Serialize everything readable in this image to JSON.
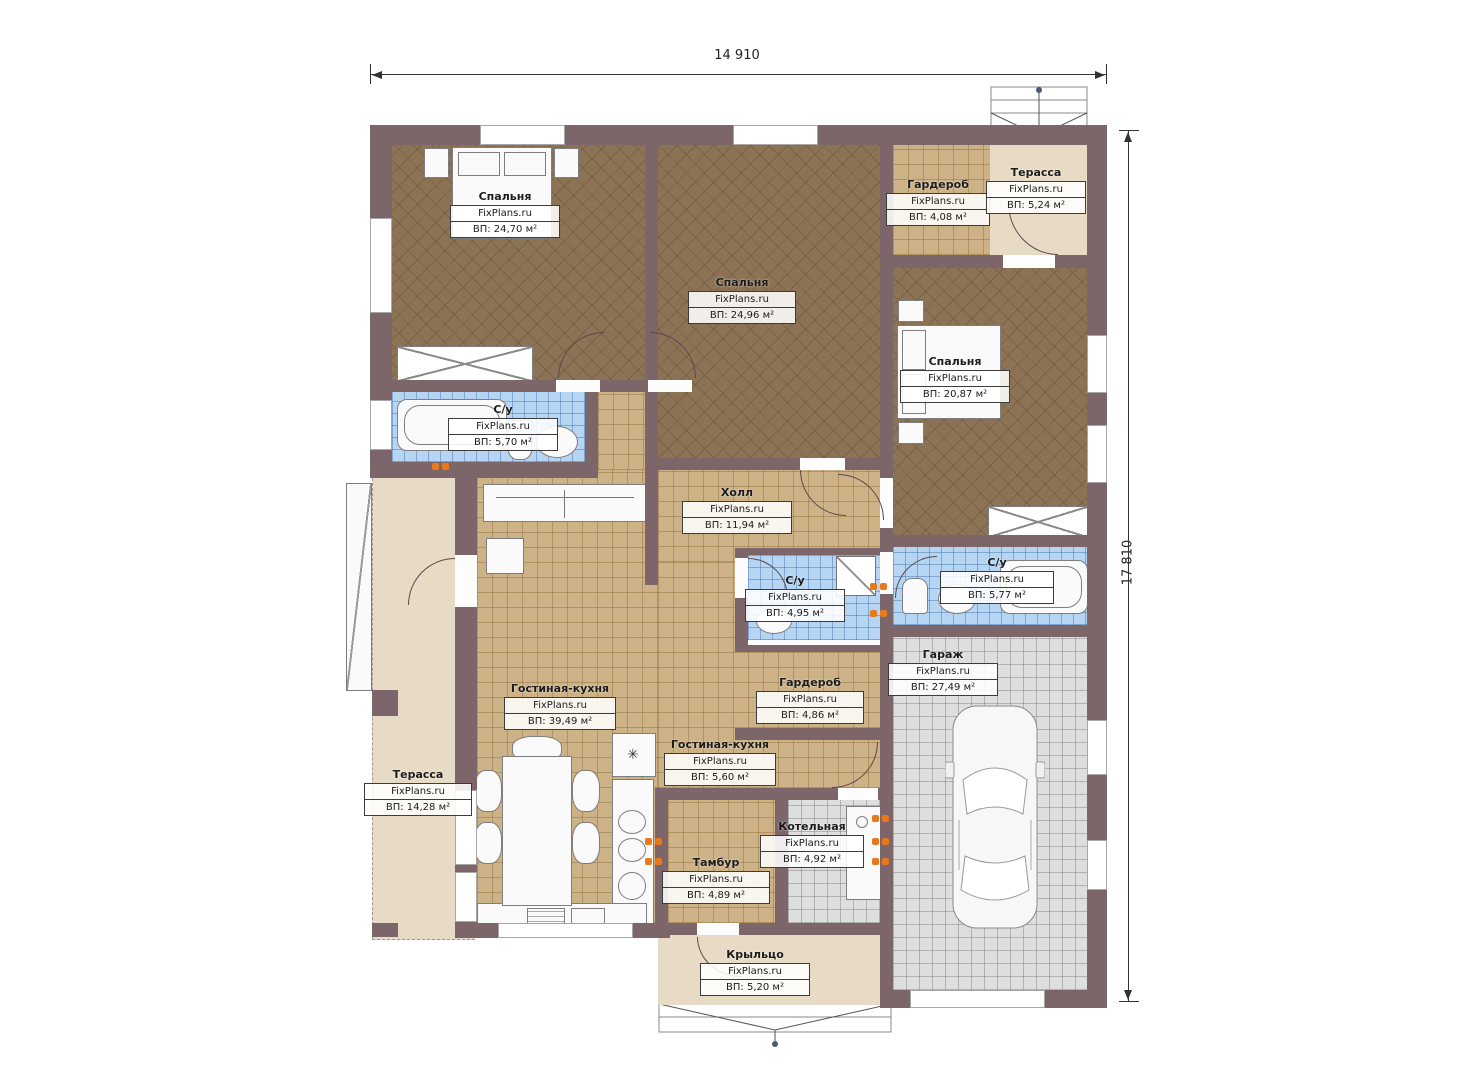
{
  "watermark": "FixPlans.ru",
  "dimensions": {
    "width": "14 910",
    "height": "17 810"
  },
  "icons": {
    "burner": "✳"
  },
  "colors": {
    "wall": "#7c6669",
    "bedroom_floor": "#8c7355",
    "hall_floor": "#cdb287",
    "bathroom_floor": "#b5d5f3",
    "garage_floor": "#dedede",
    "terrace_floor": "#e8dbc5",
    "radiator": "#e8791f"
  },
  "rooms": [
    {
      "key": "bedroom-top-left",
      "name": "Спальня",
      "area": "ВП: 24,70 м²"
    },
    {
      "key": "bedroom-top-middle",
      "name": "Спальня",
      "area": "ВП: 24,96 м²"
    },
    {
      "key": "wardrobe-top",
      "name": "Гардероб",
      "area": "ВП: 4,08 м²"
    },
    {
      "key": "terrace-top",
      "name": "Терасса",
      "area": "ВП: 5,24 м²"
    },
    {
      "key": "bedroom-right",
      "name": "Спальня",
      "area": "ВП: 20,87 м²"
    },
    {
      "key": "bathroom-left",
      "name": "С/у",
      "area": "ВП: 5,70 м²"
    },
    {
      "key": "hall",
      "name": "Холл",
      "area": "ВП: 11,94 м²"
    },
    {
      "key": "bathroom-middle",
      "name": "С/у",
      "area": "ВП: 4,95 м²"
    },
    {
      "key": "bathroom-right",
      "name": "С/у",
      "area": "ВП: 5,77 м²"
    },
    {
      "key": "garage",
      "name": "Гараж",
      "area": "ВП: 27,49 м²"
    },
    {
      "key": "living-kitchen",
      "name": "Гостиная-кухня",
      "area": "ВП: 39,49 м²"
    },
    {
      "key": "wardrobe-middle",
      "name": "Гардероб",
      "area": "ВП: 4,86 м²"
    },
    {
      "key": "living-kitchen-pass",
      "name": "Гостиная-кухня",
      "area": "ВП: 5,60 м²"
    },
    {
      "key": "terrace-left",
      "name": "Терасса",
      "area": "ВП: 14,28 м²"
    },
    {
      "key": "boiler",
      "name": "Котельная",
      "area": "ВП: 4,92 м²"
    },
    {
      "key": "tambour",
      "name": "Тамбур",
      "area": "ВП: 4,89 м²"
    },
    {
      "key": "porch",
      "name": "Крыльцо",
      "area": "ВП: 5,20 м²"
    }
  ]
}
